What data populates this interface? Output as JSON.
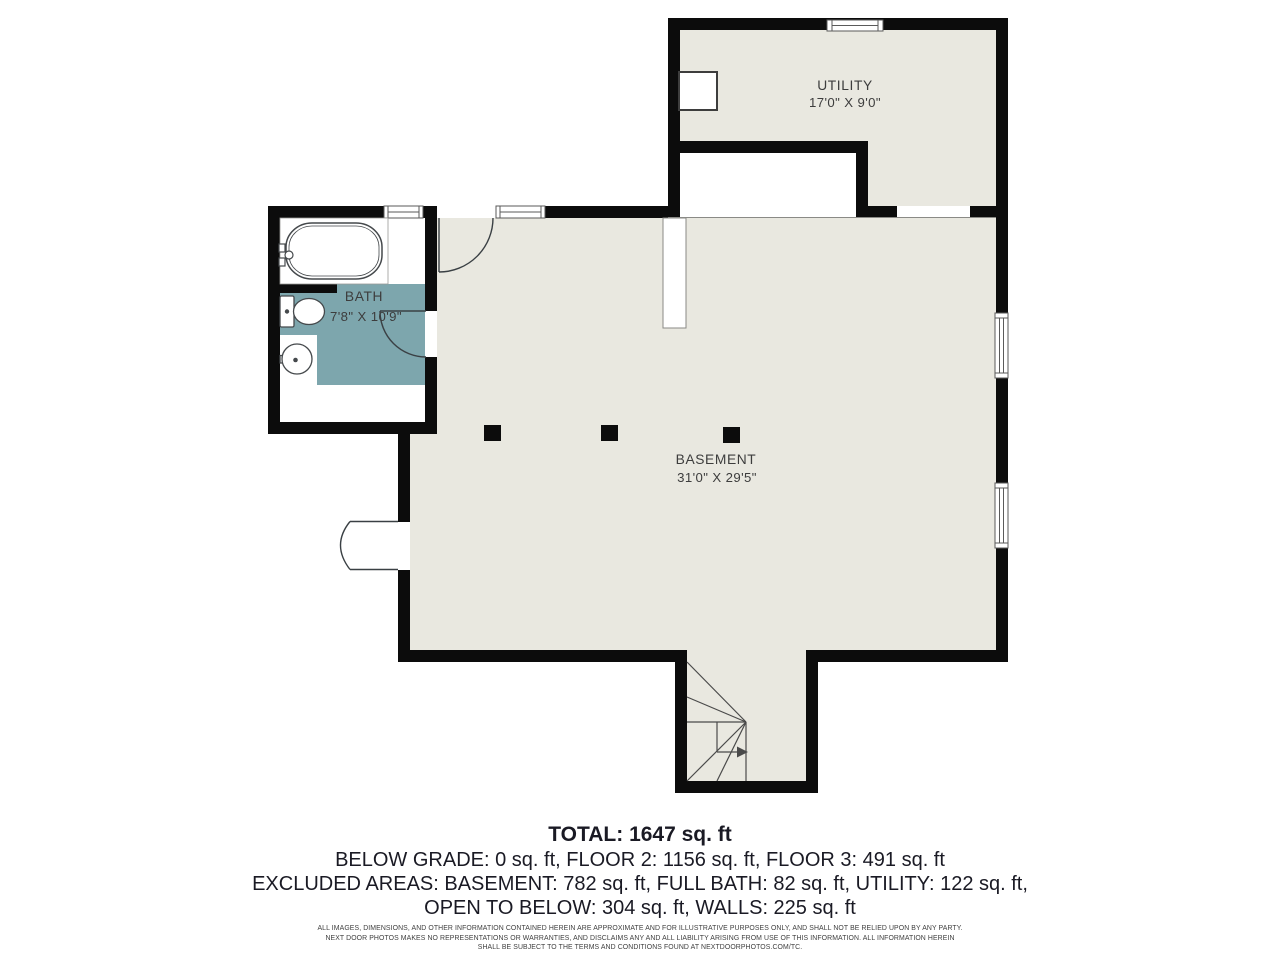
{
  "rooms": [
    {
      "name": "UTILITY",
      "dims": "17'0\" X 9'0\""
    },
    {
      "name": "BATH",
      "dims": "7'8\" X 10'9\""
    },
    {
      "name": "BASEMENT",
      "dims": "31'0\" X 29'5\""
    }
  ],
  "summary": {
    "total": "TOTAL: 1647 sq. ft",
    "line2": "BELOW GRADE: 0 sq. ft, FLOOR 2: 1156 sq. ft, FLOOR 3: 491 sq. ft",
    "line3": "EXCLUDED AREAS: BASEMENT: 782 sq. ft, FULL BATH: 82 sq. ft, UTILITY: 122 sq. ft,",
    "line4": "OPEN TO BELOW: 304 sq. ft, WALLS: 225 sq. ft"
  },
  "disclaimer": {
    "line1": "ALL IMAGES, DIMENSIONS, AND OTHER INFORMATION CONTAINED HEREIN ARE APPROXIMATE AND FOR ILLUSTRATIVE PURPOSES ONLY, AND SHALL NOT BE RELIED UPON BY ANY PARTY.",
    "line2": "NEXT DOOR PHOTOS MAKES NO REPRESENTATIONS OR WARRANTIES, AND DISCLAIMS ANY AND ALL LIABILITY ARISING FROM USE OF THIS INFORMATION. ALL INFORMATION HEREIN",
    "line3": "SHALL BE SUBJECT TO THE TERMS AND CONDITIONS FOUND AT NEXTDOORPHOTOS.COM/TC."
  },
  "colors": {
    "wall": "#0c0c0c",
    "floor": "#e9e8e0",
    "bath_accent": "#7da6ad",
    "line": "#4a4a4a",
    "fixture_line": "#3a4044"
  }
}
